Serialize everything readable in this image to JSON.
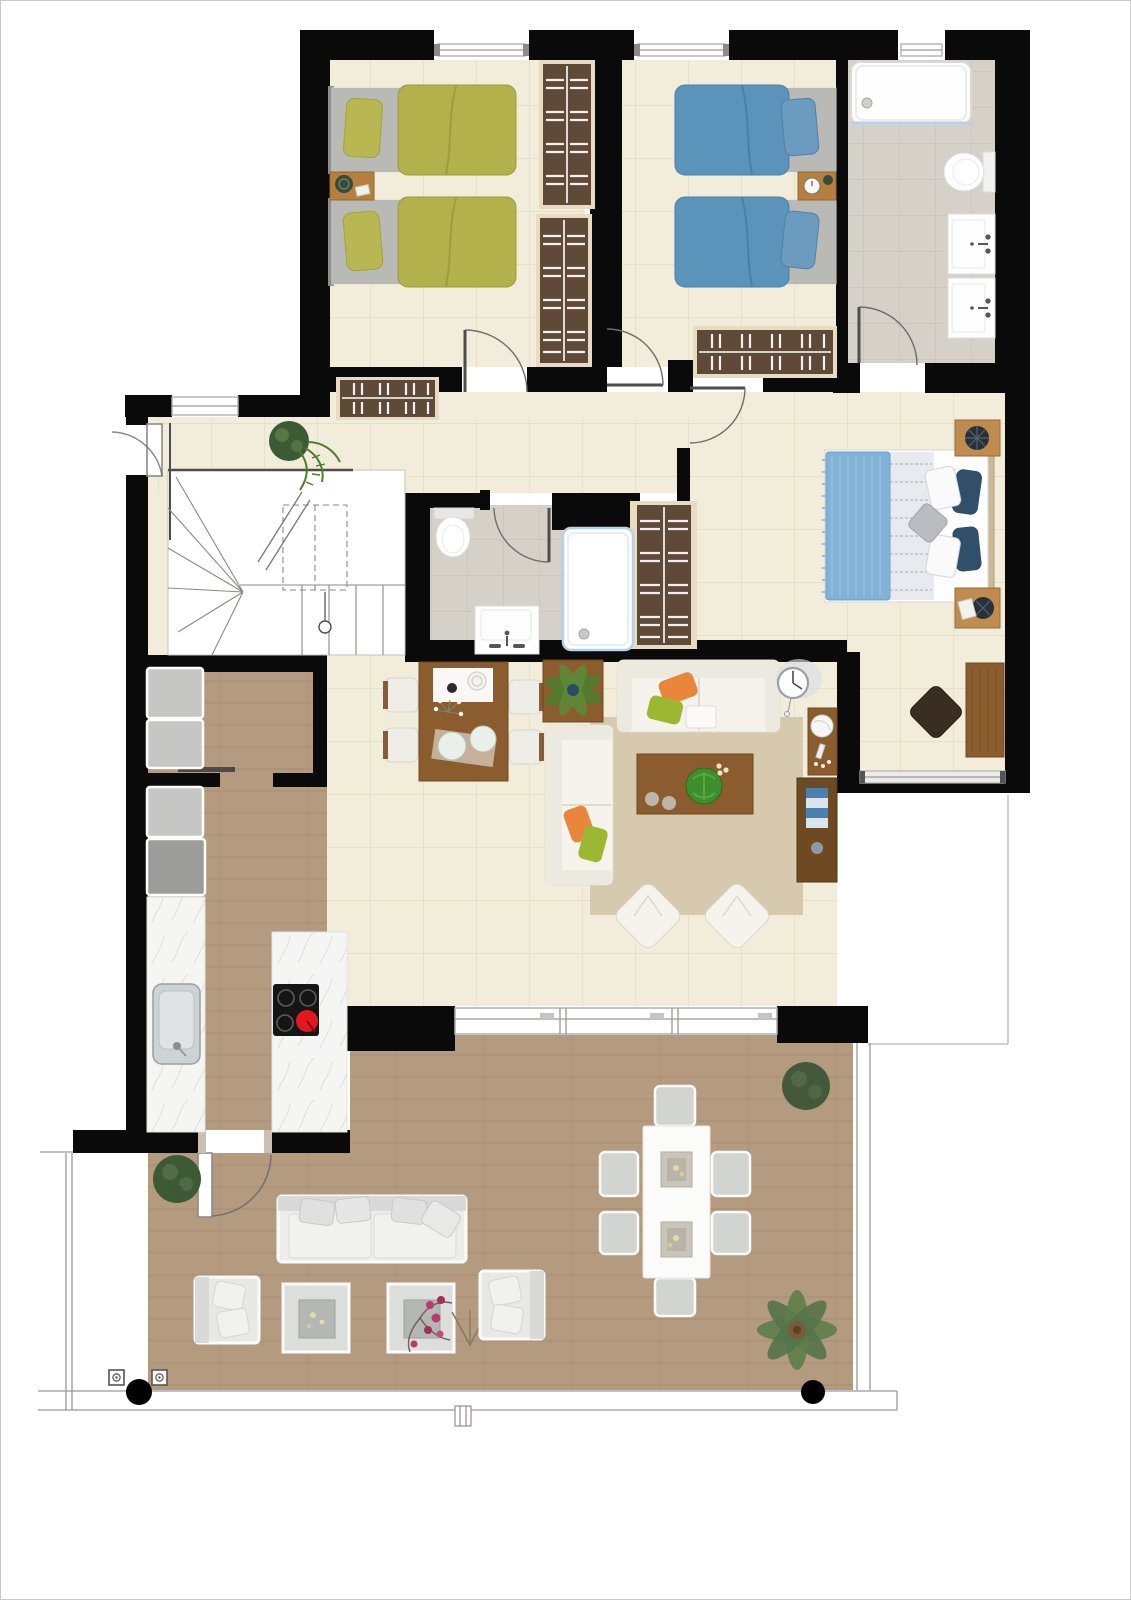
{
  "meta": {
    "kind": "apartment floor plan, top-down rendered view",
    "width_px": 1131,
    "height_px": 1600,
    "visible_text": "none"
  },
  "colors": {
    "wall": "#0a0a0a",
    "floorCream": "#f2edda",
    "tileLine": "#e3dcc3",
    "woodFloor": "#b49a7f",
    "woodFloorLine": "#a1846a",
    "bathTile": "#d5d0c8",
    "bathTileLine": "#c5c0b8",
    "marble": "#f5f5f3",
    "marbleVein": "#dcdcda",
    "wood": "#8a5c2e",
    "woodDark": "#6e4a22",
    "wardrobe": "#5e4a37",
    "wardrobeFrame": "#e7dbc2",
    "olive": "#b2b14c",
    "oliveDeep": "#9d9c3e",
    "blue": "#5b93ba",
    "blueDeep": "#4a80a8",
    "throwBlue": "#83b2d8",
    "navy": "#2f4f6b",
    "mattressGrey": "#b9b9b6",
    "applGrey": "#c6c6c4",
    "applDark": "#9c9c9a",
    "sinkGrey": "#cdd2d4",
    "orange": "#e8863b",
    "green": "#9cb832",
    "rug": "#d6c9ad",
    "sofa": "#f5f3eb",
    "sofaShade": "#dfdcd1",
    "red": "#e0191f",
    "glassBlue": "#b5d2ec",
    "plantGreen": "#4e7d2e",
    "plantDark": "#3c5a34",
    "outline": "#9a9896",
    "railGrey": "#bdbbb7"
  },
  "rooms": [
    {
      "name": "Bedroom with two olive twin beds",
      "furniture": [
        "twin bed",
        "twin bed",
        "nightstand",
        "two wardrobes",
        "window"
      ]
    },
    {
      "name": "Bedroom with two blue twin beds",
      "furniture": [
        "twin bed",
        "twin bed",
        "nightstand",
        "wardrobe",
        "window"
      ]
    },
    {
      "name": "Family bathroom",
      "furniture": [
        "bathtub",
        "toilet",
        "washbasin",
        "washbasin"
      ]
    },
    {
      "name": "Master bedroom",
      "furniture": [
        "double bed",
        "nightstand",
        "nightstand",
        "desk",
        "chair",
        "window"
      ]
    },
    {
      "name": "Shower bathroom",
      "furniture": [
        "shower",
        "toilet",
        "washbasin",
        "wardrobe"
      ]
    },
    {
      "name": "Hall and staircase",
      "furniture": [
        "staircase",
        "entrance door",
        "potted plant",
        "wardrobe"
      ]
    },
    {
      "name": "Kitchen and utility",
      "furniture": [
        "appliance column",
        "worktop with sink",
        "island with induction hob"
      ]
    },
    {
      "name": "Living and dining room",
      "furniture": [
        "dining table",
        "four chairs",
        "potted palm",
        "two sofas",
        "coffee table",
        "rug",
        "two floor cushions",
        "wall clock",
        "media units",
        "sliding glass door"
      ]
    },
    {
      "name": "Terrace",
      "furniture": [
        "outdoor sofa",
        "two armchairs",
        "two side tables",
        "outdoor dining table",
        "six chairs",
        "three plants",
        "wood deck",
        "railing",
        "two columns"
      ]
    }
  ]
}
